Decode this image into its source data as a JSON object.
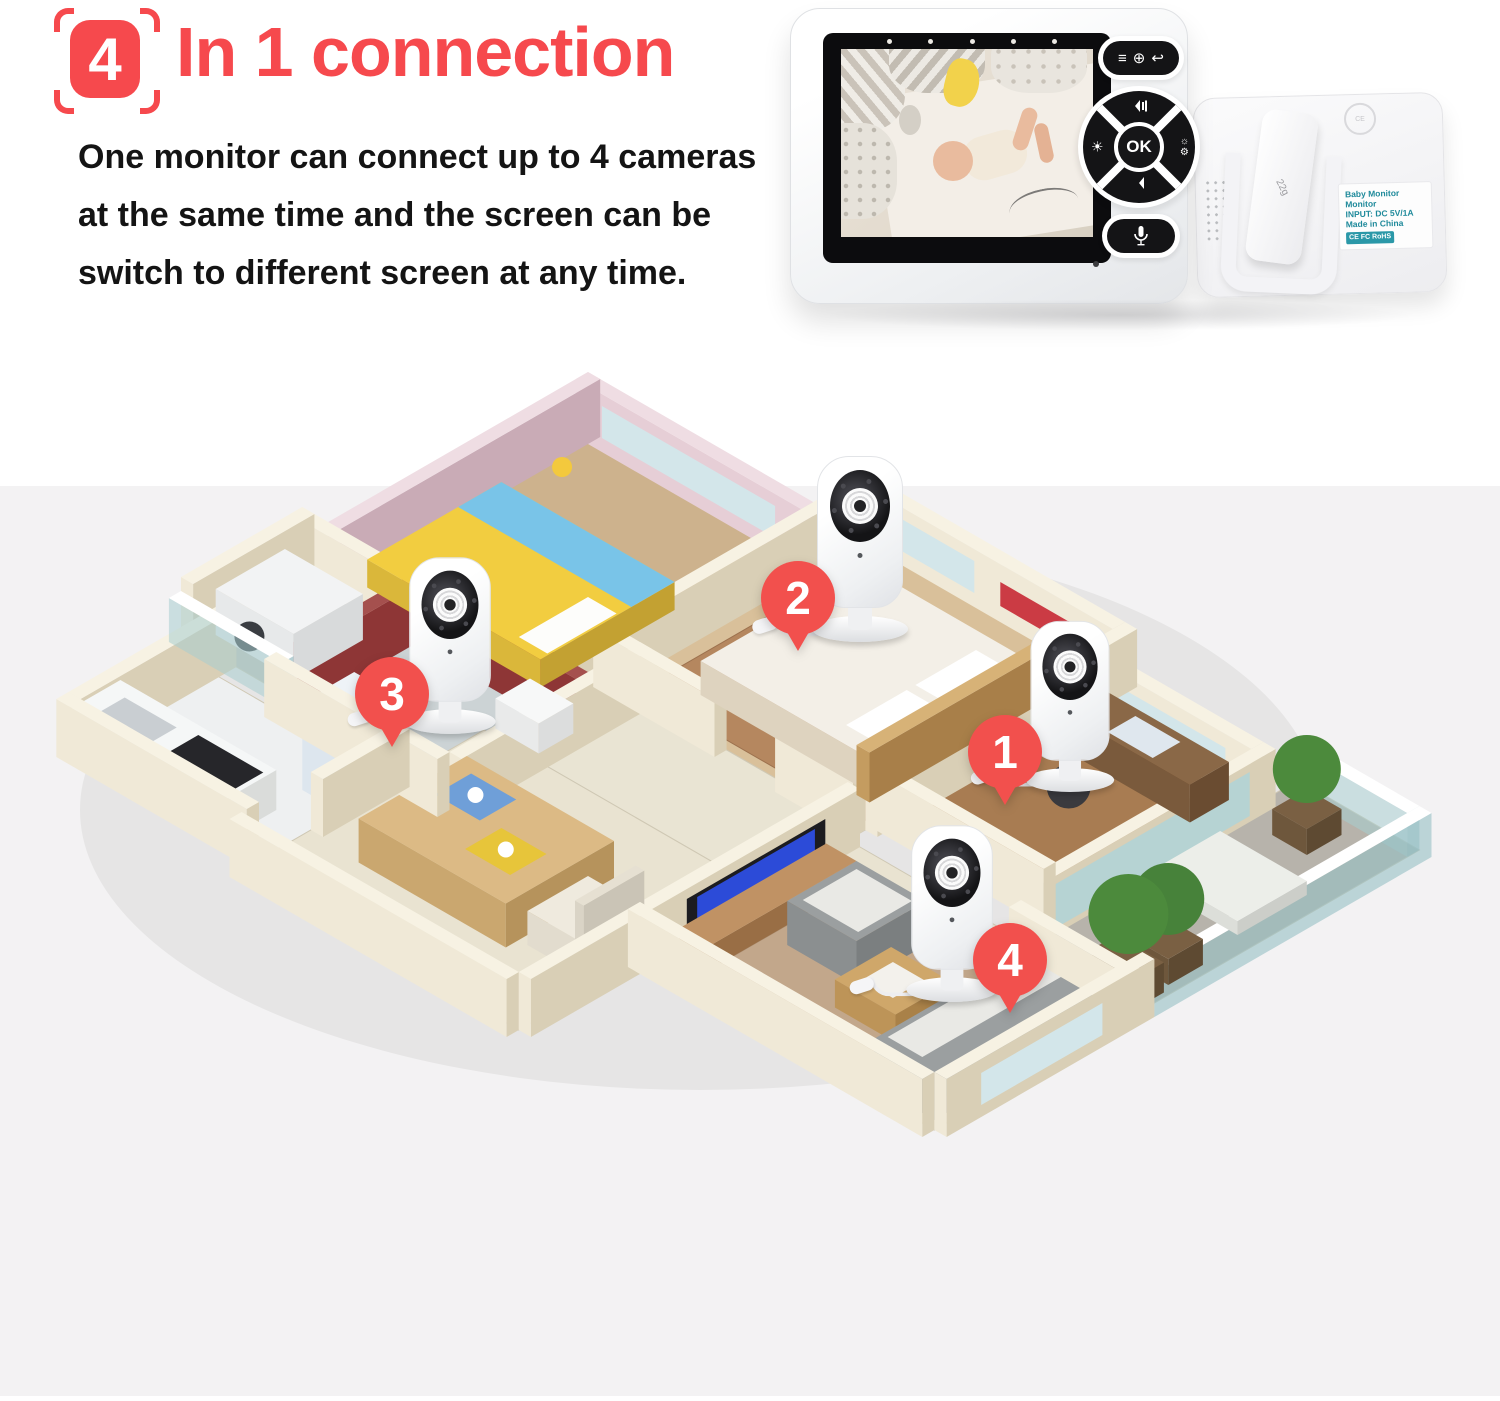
{
  "header": {
    "badge_number": "4",
    "title": "In 1 connection",
    "description_lines": [
      "One monitor can connect up to 4 cameras",
      "at the same time and the screen can be",
      "switch to different screen at any time."
    ]
  },
  "monitor": {
    "ok_label": "OK",
    "led_count": 5,
    "back_unit": {
      "clip_text": "22g",
      "stamp_text": "CE",
      "label_lines": [
        "Baby Monitor",
        "Monitor",
        "INPUT: DC 5V/1A",
        "Made in China"
      ],
      "cert_text": "CE FC RoHS"
    }
  },
  "floorplan": {
    "markers": [
      {
        "number": "1",
        "room": "office"
      },
      {
        "number": "2",
        "room": "master-bedroom"
      },
      {
        "number": "3",
        "room": "bathroom"
      },
      {
        "number": "4",
        "room": "living-room"
      }
    ]
  },
  "colors": {
    "accent_red": "#f6494d",
    "marker_red": "#f2504d",
    "text": "#141414",
    "band_background": "#f3f2f3",
    "label_teal": "#1f8a9b"
  }
}
